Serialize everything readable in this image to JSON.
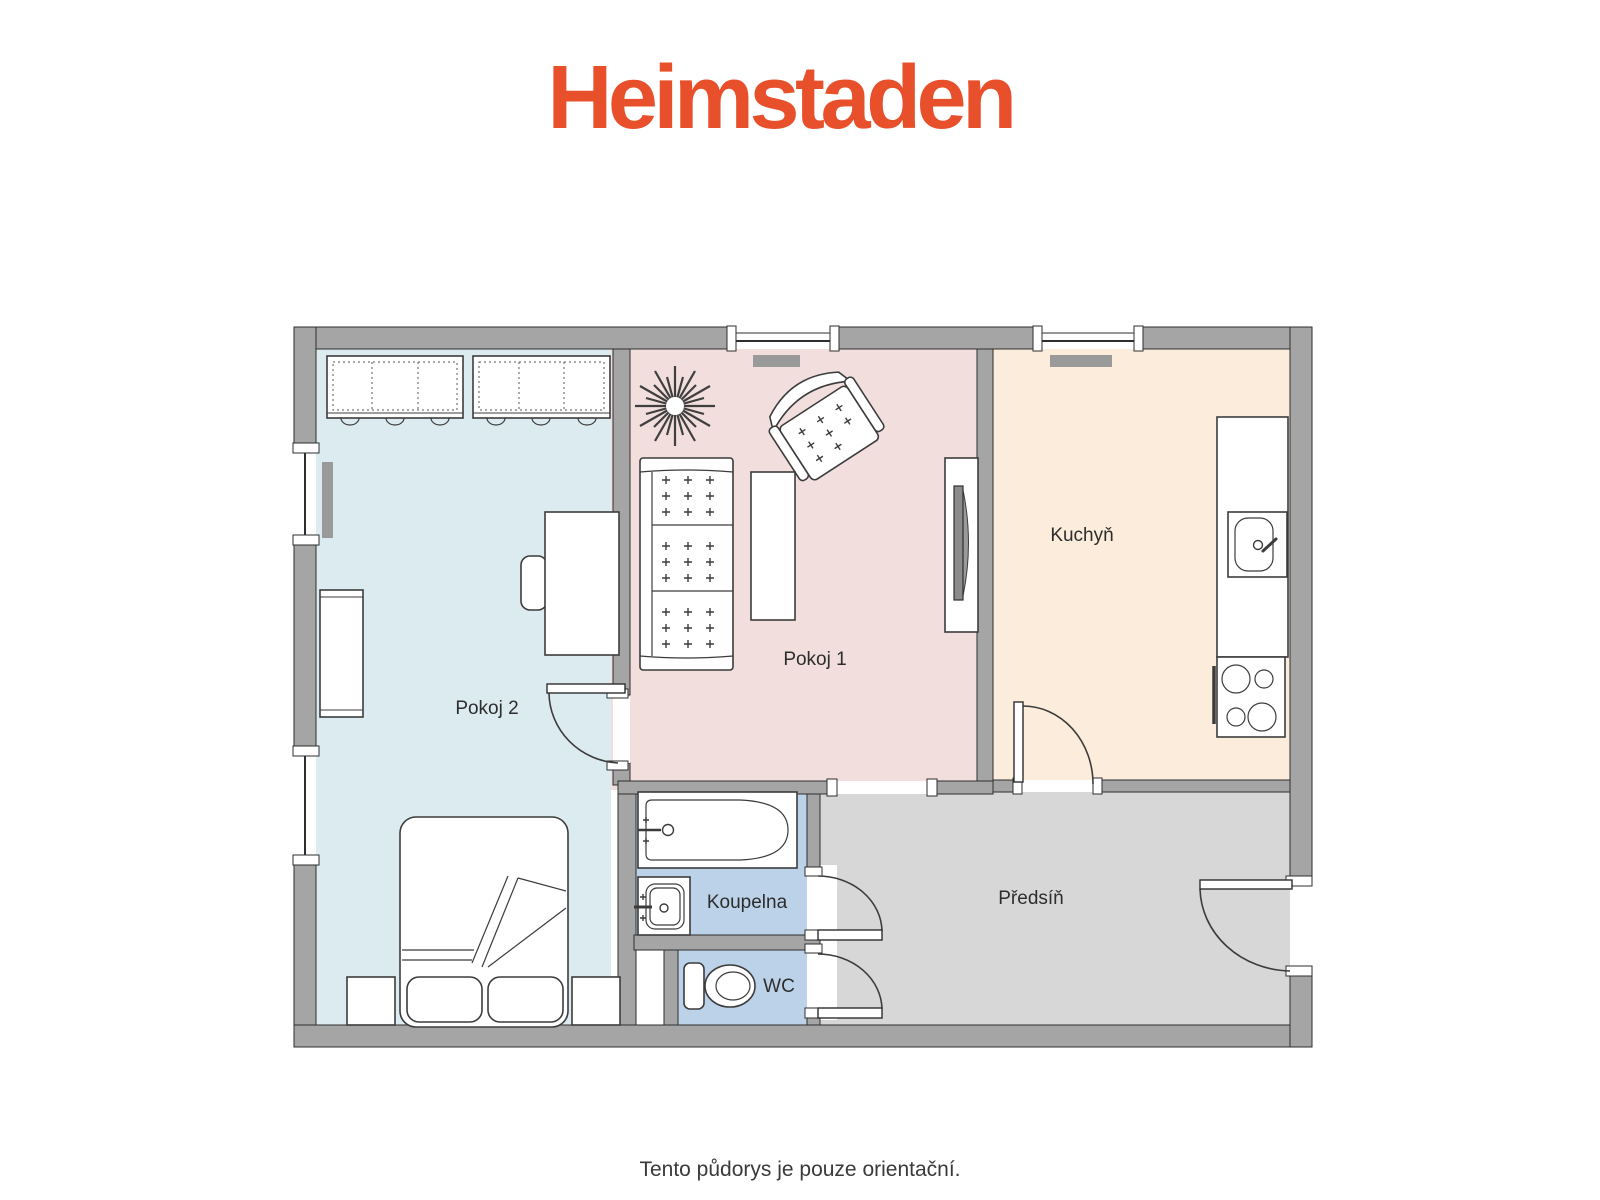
{
  "logo": {
    "text": "Heimstaden",
    "color": "#e8502c"
  },
  "footer": {
    "note": "Tento půdorys je pouze orientační."
  },
  "palette": {
    "wall": "#a5a5a5",
    "wall_outline": "#2e2e2e",
    "radiator": "#9a9a9a",
    "furniture_outline": "#3c3c3c",
    "label_color": "#2d2d2d"
  },
  "rooms": {
    "pokoj2": {
      "label": "Pokoj 2",
      "color": "#dcebf0"
    },
    "pokoj1": {
      "label": "Pokoj 1",
      "color": "#f1dedd"
    },
    "kuchyn": {
      "label": "Kuchyň",
      "color": "#fbecdc"
    },
    "koupelna": {
      "label": "Koupelna",
      "color": "#bcd2e8"
    },
    "wc": {
      "label": "WC",
      "color": "#bcd2e8"
    },
    "predsin": {
      "label": "Předsíň",
      "color": "#d7d7d7"
    }
  }
}
